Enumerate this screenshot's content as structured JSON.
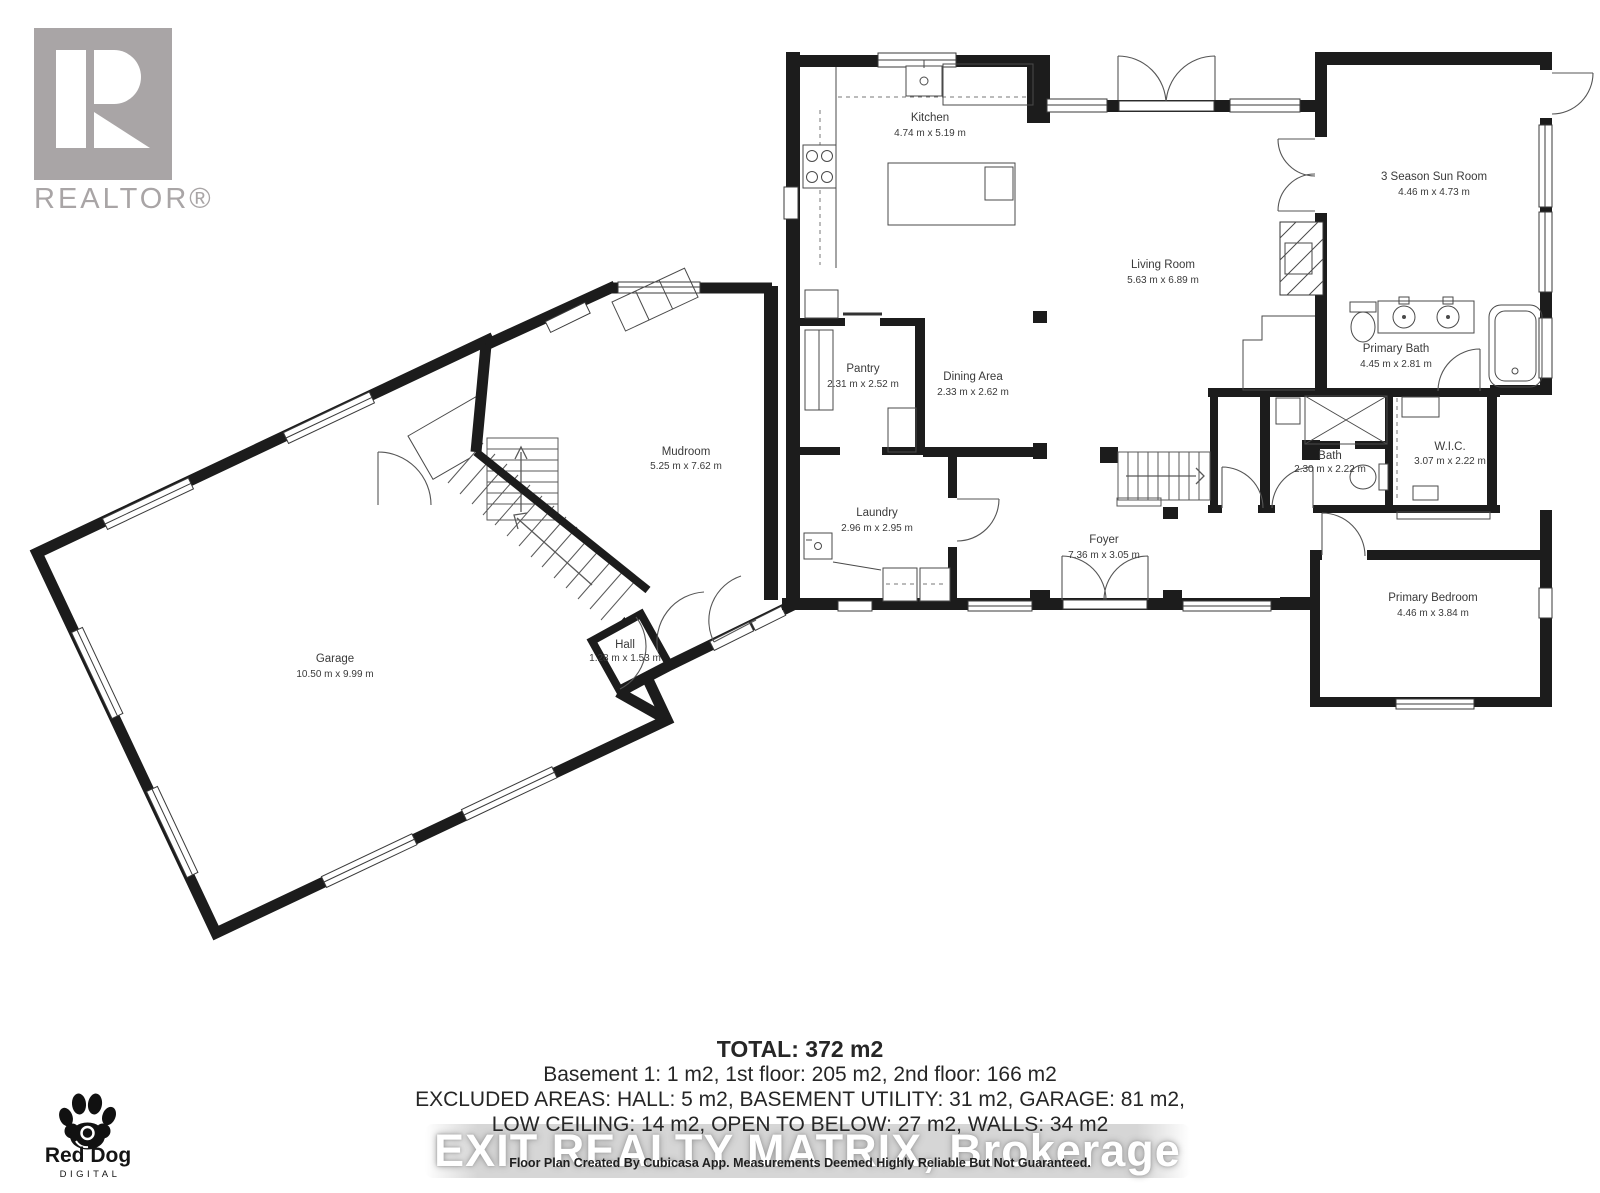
{
  "branding": {
    "realtor_wordmark": "REALTOR®",
    "reddog_name": "Red Dog",
    "reddog_sub": "DIGITAL"
  },
  "watermark": "EXIT REALTY MATRIX, Brokerage",
  "rooms": {
    "kitchen": {
      "name": "Kitchen",
      "dims": "4.74 m x 5.19 m"
    },
    "living_room": {
      "name": "Living Room",
      "dims": "5.63 m x 6.89 m"
    },
    "sun_room": {
      "name": "3 Season Sun Room",
      "dims": "4.46 m x 4.73 m"
    },
    "primary_bath": {
      "name": "Primary Bath",
      "dims": "4.45 m x 2.81 m"
    },
    "wic": {
      "name": "W.I.C.",
      "dims": "3.07 m x 2.22 m"
    },
    "bath": {
      "name": "Bath",
      "dims": "2.30 m x 2.22 m"
    },
    "primary_bedroom": {
      "name": "Primary Bedroom",
      "dims": "4.46 m x 3.84 m"
    },
    "foyer": {
      "name": "Foyer",
      "dims": "7.36 m x 3.05 m"
    },
    "laundry": {
      "name": "Laundry",
      "dims": "2.96 m x 2.95 m"
    },
    "pantry": {
      "name": "Pantry",
      "dims": "2.31 m x 2.52 m"
    },
    "dining_area": {
      "name": "Dining Area",
      "dims": "2.33 m x 2.62 m"
    },
    "mudroom": {
      "name": "Mudroom",
      "dims": "5.25 m x 7.62 m"
    },
    "hall": {
      "name": "Hall",
      "dims": "1.28 m x 1.53 m"
    },
    "garage": {
      "name": "Garage",
      "dims": "10.50 m x 9.99 m"
    }
  },
  "summary": {
    "total": "TOTAL: 372 m2",
    "line1": "Basement 1: 1 m2, 1st floor: 205 m2, 2nd floor: 166 m2",
    "line2": "EXCLUDED AREAS: HALL: 5 m2, BASEMENT UTILITY: 31 m2, GARAGE: 81 m2,",
    "line3": "LOW CEILING: 14 m2, OPEN TO BELOW: 27 m2, WALLS: 34 m2"
  },
  "footer": "Floor Plan Created By Cubicasa App. Measurements Deemed Highly Reliable But Not Guaranteed.",
  "colors": {
    "wall": "#1c1c1c",
    "line": "#4a4a4a",
    "label": "#3a3a3a",
    "logo_gray": "#a9a5a6"
  }
}
